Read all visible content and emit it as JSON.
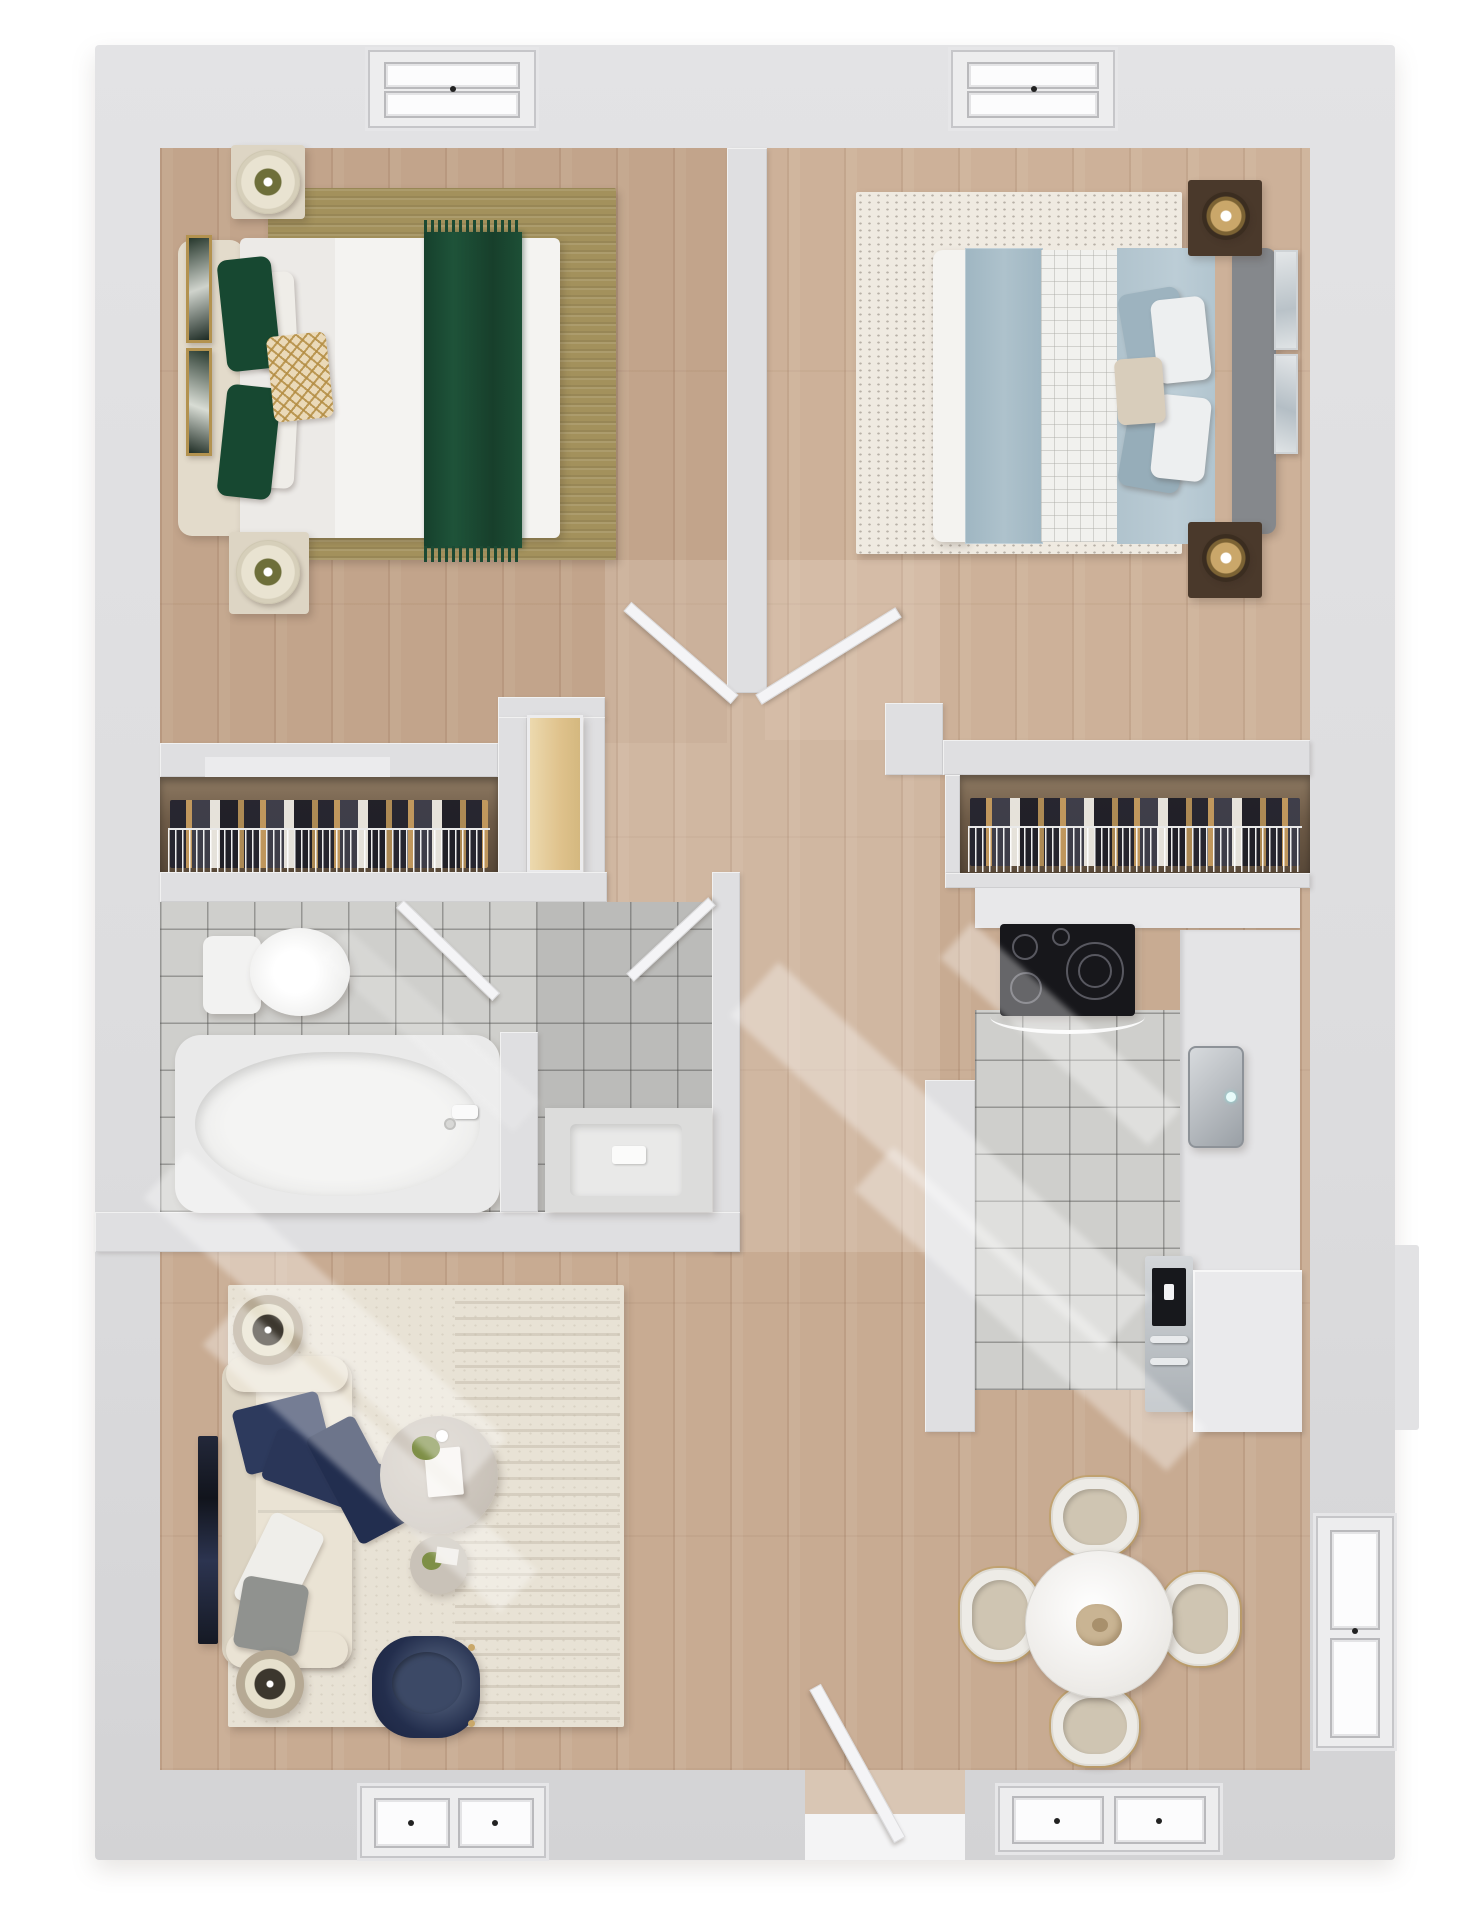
{
  "title": "3d-apartment-floor-plan-top-view",
  "colors": {
    "background": "#ffffff",
    "wall": "#dfdfe1",
    "wall_dark": "#d2d2d4",
    "wall_light": "#ebebed",
    "wood_floor": "#c8ab92",
    "tile_floor": "#cfcfcc",
    "rug_gold": "#a3915c",
    "rug_cream": "#e8e2d5",
    "rug_speckled": "#efeae1",
    "bed_green": "#1d5038",
    "bed_white": "#f2f1ef",
    "bed_blue": "#b7c9d2",
    "sofa_cream": "#e5decf",
    "pillow_navy": "#2d3a5d",
    "chair_navy": "#232e4d",
    "closet_wood": "#6f5c48",
    "door_tan": "#e2c astute",
    "stove_black": "#17171b",
    "steel": "#b9bcc0",
    "marble": "#f2f0ec",
    "gold": "#c9a86a",
    "plant_green": "#7e8f46"
  },
  "rooms": [
    {
      "name": "bedroom-1",
      "position": "top-left",
      "furniture": [
        "upholstered-bed-cream-headboard",
        "white-duvet",
        "emerald-velvet-runner-with-fringe",
        "two-green-pillows",
        "two-white-pillows",
        "gold-trellis-accent-pillow",
        "gold-area-rug",
        "nightstand-with-drum-lamp-top",
        "nightstand-with-drum-lamp-bottom",
        "two-framed-artworks-left-wall",
        "double-hung-window-top-wall"
      ]
    },
    {
      "name": "bedroom-2",
      "position": "top-right",
      "furniture": [
        "platform-bed-gray-headboard",
        "light-blue-duvet",
        "herringbone-blue-runner",
        "white-grid-quilt",
        "four-blue-gray-pillows",
        "two-white-pillows",
        "beige-accent-pillow",
        "distressed-ivory-rug",
        "dark-wood-nightstand-gold-lamp-top",
        "dark-wood-nightstand-gold-lamp-bottom",
        "two-framed-artworks-right-wall",
        "double-hung-window-top-wall"
      ]
    },
    {
      "name": "closet-1",
      "position": "mid-left",
      "furniture": [
        "wire-shelf",
        "hanging-clothes",
        "wood-closet-door"
      ]
    },
    {
      "name": "closet-2",
      "position": "mid-right",
      "furniture": [
        "wire-shelf",
        "hanging-clothes"
      ]
    },
    {
      "name": "bathroom",
      "position": "mid-left",
      "furniture": [
        "toilet",
        "soaking-bathtub",
        "tub-faucet",
        "partition-wall",
        "vanity-counter-with-sink",
        "entry-door-ajar",
        "inner-door-ajar",
        "gray-tile-floor"
      ]
    },
    {
      "name": "kitchen",
      "position": "mid-right",
      "furniture": [
        "black-cooktop-four-burners",
        "top-counter",
        "right-counter-run",
        "stainless-sink-with-faucet",
        "stainless-wall-oven",
        "lower-cabinet",
        "gray-tile-floor"
      ]
    },
    {
      "name": "hallway",
      "position": "center",
      "furniture": [
        "two-bedroom-doors-ajar-v-shape",
        "wood-plank-floor"
      ]
    },
    {
      "name": "living-room",
      "position": "bottom-left",
      "furniture": [
        "cream-three-seat-sofa",
        "navy-pillow",
        "navy-throw-blanket",
        "white-lumbar-pillow",
        "gray-pillow",
        "round-side-table-lamp-top",
        "round-side-table-lamp-bottom",
        "wall-mounted-tv",
        "round-coffee-table-books-plant",
        "round-accent-table-plant",
        "navy-barrel-chair-gold-legs",
        "textured-cream-rug"
      ]
    },
    {
      "name": "dining-area",
      "position": "bottom-right",
      "furniture": [
        "round-marble-table",
        "four-upholstered-chairs-gold-frame",
        "dried-floral-centerpiece"
      ]
    }
  ],
  "exterior": {
    "windows": [
      "bedroom-1-top-window",
      "bedroom-2-top-window",
      "living-room-bottom-window",
      "dining-bottom-window",
      "dining-right-window"
    ],
    "doors": [
      "entry-door-open-bottom-center"
    ],
    "effects": [
      "diagonal-sunlight-streaks"
    ]
  }
}
